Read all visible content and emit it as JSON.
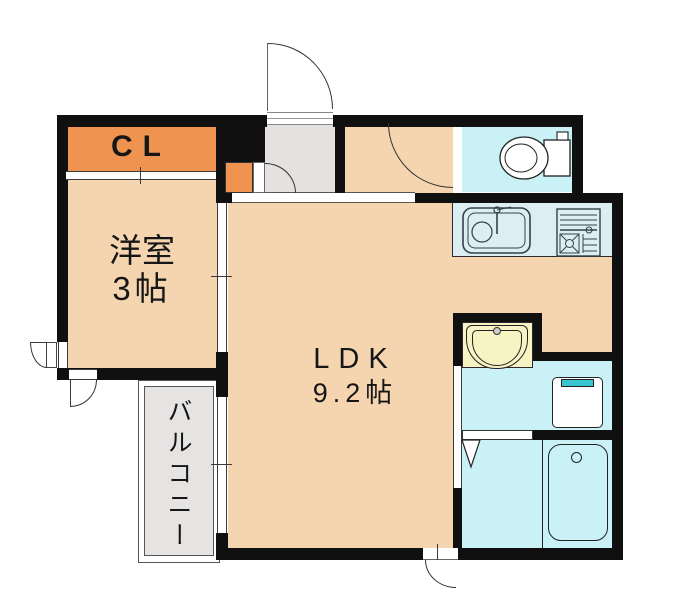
{
  "plan_title": "1LDK floor plan",
  "rooms": {
    "closet": {
      "label": "CL"
    },
    "western_room": {
      "name": "洋室",
      "size": "3帖"
    },
    "ldk": {
      "name": "LDK",
      "size": "9.2帖"
    },
    "balcony": {
      "name": "バルコニー"
    }
  },
  "fixtures": [
    "entrance-door",
    "entry-step",
    "shoe-box",
    "toilet",
    "kitchen-sink",
    "gas-stove",
    "washbasin",
    "washing-machine",
    "bathtub",
    "sliding-door",
    "window",
    "bath-folding-door",
    "service-door"
  ],
  "colors": {
    "wall": "#101010",
    "room_floor": "#f5d5b0",
    "closet_orange": "#ee9450",
    "wet_area_cyan": "#c9f1f6",
    "washbasin_yellow": "#f8f3c3",
    "entry_gray": "#e6e1e1",
    "balcony_gray": "#e6e3e3",
    "kitchen_counter": "#dceef2",
    "washer_accent": "#38c5ce"
  }
}
